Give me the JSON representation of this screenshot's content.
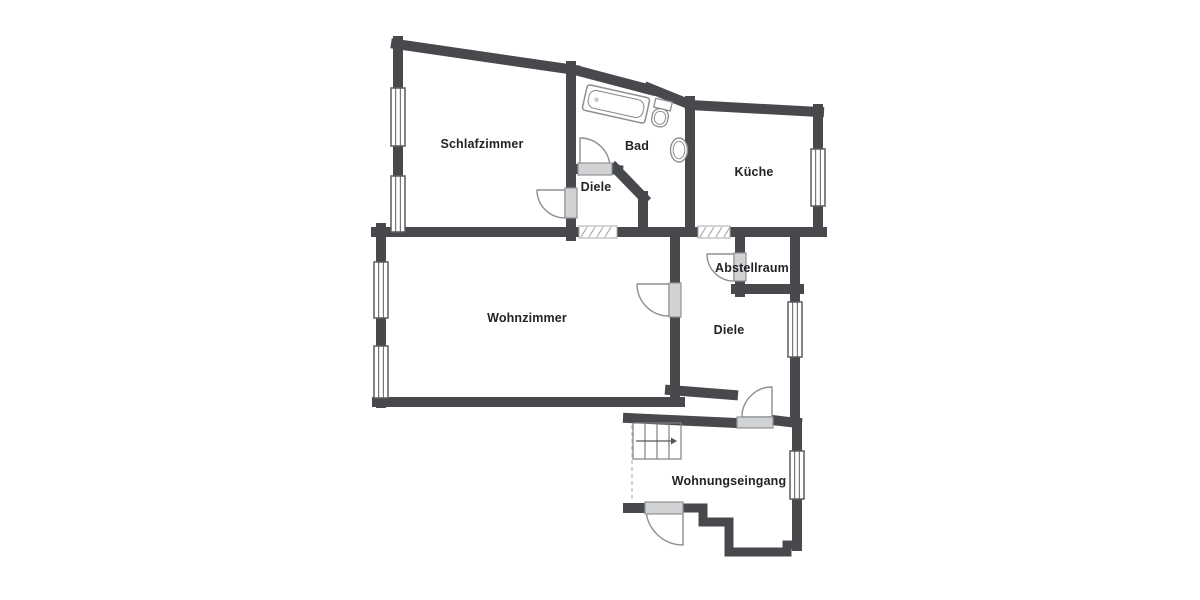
{
  "floorplan": {
    "background": "#ffffff",
    "wall_color": "#47494d",
    "line_color": "#8d8f92",
    "sill_fill": "#d0d2d4",
    "sill_border": "#909396",
    "window_border": "#5a5c60",
    "hatch_color": "#a8aaac",
    "stairs_color": "#7e8083",
    "text_color": "#222326",
    "rooms": [
      {
        "id": "schlafzimmer",
        "label": "Schlafzimmer",
        "cx": 482,
        "cy": 144
      },
      {
        "id": "bad",
        "label": "Bad",
        "cx": 637,
        "cy": 146
      },
      {
        "id": "diele-oben",
        "label": "Diele",
        "cx": 596,
        "cy": 187
      },
      {
        "id": "kueche",
        "label": "Küche",
        "cx": 754,
        "cy": 172
      },
      {
        "id": "wohnzimmer",
        "label": "Wohnzimmer",
        "cx": 527,
        "cy": 318
      },
      {
        "id": "abstellraum",
        "label": "Abstellraum",
        "cx": 752,
        "cy": 268
      },
      {
        "id": "diele-unten",
        "label": "Diele",
        "cx": 729,
        "cy": 330
      },
      {
        "id": "wohnungseingang",
        "label": "Wohnungseingang",
        "cx": 729,
        "cy": 481
      }
    ],
    "walls": [
      {
        "name": "schlafzimmer-top",
        "w": 10,
        "pts": [
          [
            396,
            44
          ],
          [
            575,
            70
          ]
        ]
      },
      {
        "name": "bad-top-a",
        "w": 10,
        "pts": [
          [
            575,
            70
          ],
          [
            651,
            90
          ]
        ]
      },
      {
        "name": "bad-top-b",
        "w": 10,
        "pts": [
          [
            649,
            88
          ],
          [
            691,
            105
          ]
        ]
      },
      {
        "name": "kueche-top",
        "w": 10,
        "pts": [
          [
            690,
            105
          ],
          [
            819,
            112
          ]
        ]
      },
      {
        "name": "kueche-right-upper",
        "w": 10,
        "pts": [
          [
            818,
            109
          ],
          [
            818,
            150
          ]
        ]
      },
      {
        "name": "kueche-right-lower",
        "w": 10,
        "pts": [
          [
            818,
            205
          ],
          [
            818,
            232
          ]
        ]
      },
      {
        "name": "schlafzimmer-left-upper",
        "w": 10,
        "pts": [
          [
            398,
            41
          ],
          [
            398,
            90
          ]
        ]
      },
      {
        "name": "schlafzimmer-left-mid",
        "w": 10,
        "pts": [
          [
            398,
            143
          ],
          [
            398,
            179
          ]
        ]
      },
      {
        "name": "schlafzimmer-right-up",
        "w": 10,
        "pts": [
          [
            571,
            66
          ],
          [
            571,
            190
          ]
        ]
      },
      {
        "name": "schlafzimmer-right-low",
        "w": 10,
        "pts": [
          [
            571,
            217
          ],
          [
            571,
            236
          ]
        ]
      },
      {
        "name": "bottom-wall-west",
        "w": 10,
        "pts": [
          [
            376,
            232
          ],
          [
            579,
            232
          ]
        ]
      },
      {
        "name": "bottom-wall-mid",
        "w": 10,
        "pts": [
          [
            615,
            232
          ],
          [
            700,
            232
          ]
        ]
      },
      {
        "name": "bottom-wall-east",
        "w": 10,
        "pts": [
          [
            728,
            232
          ],
          [
            822,
            232
          ]
        ]
      },
      {
        "name": "baddoor-stub-left",
        "w": 10,
        "pts": [
          [
            571,
            169
          ],
          [
            580,
            169
          ]
        ]
      },
      {
        "name": "baddoor-stub-right",
        "w": 10,
        "pts": [
          [
            609,
            169
          ],
          [
            618,
            170
          ]
        ]
      },
      {
        "name": "diele-bad-slant",
        "w": 10,
        "pts": [
          [
            615,
            168
          ],
          [
            644,
            198
          ]
        ]
      },
      {
        "name": "diele-bad-vertical",
        "w": 10,
        "pts": [
          [
            643,
            196
          ],
          [
            643,
            232
          ]
        ]
      },
      {
        "name": "bad-kueche-shared",
        "w": 10,
        "pts": [
          [
            690,
            101
          ],
          [
            690,
            232
          ]
        ]
      },
      {
        "name": "wohnzimmer-left-upper",
        "w": 10,
        "pts": [
          [
            381,
            228
          ],
          [
            381,
            263
          ]
        ]
      },
      {
        "name": "wohnzimmer-left-mid",
        "w": 10,
        "pts": [
          [
            381,
            317
          ],
          [
            381,
            347
          ]
        ]
      },
      {
        "name": "wohnzimmer-left-stub",
        "w": 10,
        "pts": [
          [
            381,
            397
          ],
          [
            381,
            403
          ]
        ]
      },
      {
        "name": "wohnzimmer-bottom",
        "w": 10,
        "pts": [
          [
            377,
            402
          ],
          [
            680,
            402
          ]
        ]
      },
      {
        "name": "wohnzimmer-right-upper",
        "w": 10,
        "pts": [
          [
            675,
            232
          ],
          [
            675,
            284
          ]
        ]
      },
      {
        "name": "wohnzimmer-right-lower",
        "w": 10,
        "pts": [
          [
            675,
            316
          ],
          [
            675,
            401
          ]
        ]
      },
      {
        "name": "diele-bottom-slant",
        "w": 10,
        "pts": [
          [
            670,
            390
          ],
          [
            733,
            395
          ]
        ]
      },
      {
        "name": "eingang-top",
        "w": 10,
        "pts": [
          [
            628,
            418
          ],
          [
            737,
            423
          ]
        ]
      },
      {
        "name": "eingang-door-stub",
        "w": 10,
        "pts": [
          [
            772,
            420
          ],
          [
            797,
            423
          ]
        ]
      },
      {
        "name": "east-wall-upper",
        "w": 10,
        "pts": [
          [
            795,
            232
          ],
          [
            795,
            303
          ]
        ]
      },
      {
        "name": "east-wall-mid",
        "w": 10,
        "pts": [
          [
            795,
            357
          ],
          [
            795,
            421
          ]
        ]
      },
      {
        "name": "abstellraum-left-upper",
        "w": 10,
        "pts": [
          [
            740,
            237
          ],
          [
            740,
            254
          ]
        ]
      },
      {
        "name": "abstellraum-left-lower",
        "w": 10,
        "pts": [
          [
            740,
            280
          ],
          [
            740,
            292
          ]
        ]
      },
      {
        "name": "abstellraum-bottom",
        "w": 10,
        "pts": [
          [
            736,
            289
          ],
          [
            799,
            289
          ]
        ]
      },
      {
        "name": "eingang-right-upper",
        "w": 10,
        "pts": [
          [
            797,
            423
          ],
          [
            797,
            453
          ]
        ]
      },
      {
        "name": "eingang-right-lower",
        "w": 10,
        "pts": [
          [
            797,
            498
          ],
          [
            797,
            546
          ]
        ]
      },
      {
        "name": "eingang-bottom-zigzag",
        "w": 9,
        "pts": [
          [
            797,
            545
          ],
          [
            787,
            545
          ],
          [
            787,
            552
          ],
          [
            729,
            552
          ],
          [
            729,
            522
          ],
          [
            703,
            522
          ],
          [
            703,
            508
          ],
          [
            684,
            508
          ]
        ]
      },
      {
        "name": "eingang-bottom-left",
        "w": 10,
        "pts": [
          [
            646,
            508
          ],
          [
            628,
            508
          ]
        ]
      }
    ],
    "windows": [
      {
        "name": "window-schlafzimmer-1",
        "x": 391,
        "y": 88,
        "w": 14,
        "h": 58
      },
      {
        "name": "window-schlafzimmer-2",
        "x": 391,
        "y": 176,
        "w": 14,
        "h": 56
      },
      {
        "name": "window-wohnzimmer-1",
        "x": 374,
        "y": 262,
        "w": 14,
        "h": 56
      },
      {
        "name": "window-wohnzimmer-2",
        "x": 374,
        "y": 346,
        "w": 14,
        "h": 52
      },
      {
        "name": "window-kueche",
        "x": 811,
        "y": 149,
        "w": 14,
        "h": 57
      },
      {
        "name": "window-diele",
        "x": 788,
        "y": 302,
        "w": 14,
        "h": 55
      },
      {
        "name": "window-eingang",
        "x": 790,
        "y": 451,
        "w": 14,
        "h": 48
      }
    ],
    "door_sills": [
      {
        "name": "sill-schlafzimmer",
        "x": 565,
        "y": 188,
        "w": 12,
        "h": 30
      },
      {
        "name": "sill-bad",
        "x": 578,
        "y": 163,
        "w": 34,
        "h": 12
      },
      {
        "name": "sill-wohnzimmer",
        "x": 669,
        "y": 283,
        "w": 12,
        "h": 34
      },
      {
        "name": "sill-abstellraum",
        "x": 734,
        "y": 253,
        "w": 12,
        "h": 28
      },
      {
        "name": "sill-diele-eingang",
        "x": 737,
        "y": 417,
        "w": 36,
        "h": 11
      },
      {
        "name": "sill-haustuer",
        "x": 645,
        "y": 502,
        "w": 38,
        "h": 12
      }
    ],
    "door_arcs": [
      {
        "name": "door-schlafzimmer",
        "hx": 565,
        "hy": 190,
        "lx": 537,
        "ly": 190,
        "ex": 565,
        "ey": 218,
        "r": 28,
        "sweep": 0
      },
      {
        "name": "door-bad",
        "hx": 580,
        "hy": 168,
        "lx": 580,
        "ly": 138,
        "ex": 610,
        "ey": 168,
        "r": 30,
        "sweep": 1
      },
      {
        "name": "door-wohnzimmer",
        "hx": 669,
        "hy": 284,
        "lx": 637,
        "ly": 284,
        "ex": 669,
        "ey": 316,
        "r": 32,
        "sweep": 0
      },
      {
        "name": "door-abstellraum",
        "hx": 734,
        "hy": 254,
        "lx": 707,
        "ly": 254,
        "ex": 734,
        "ey": 281,
        "r": 27,
        "sweep": 0
      },
      {
        "name": "door-diele-eingang",
        "hx": 772,
        "hy": 417,
        "lx": 772,
        "ly": 387,
        "ex": 742,
        "ey": 417,
        "r": 30,
        "sweep": 0
      },
      {
        "name": "door-haustuer",
        "hx": 683,
        "hy": 508,
        "lx": 683,
        "ly": 545,
        "ex": 646,
        "ey": 508,
        "r": 37,
        "sweep": 1
      }
    ],
    "openings": [
      {
        "name": "opening-wohnzimmer-diele",
        "x": 579,
        "y": 226,
        "w": 38,
        "h": 12
      },
      {
        "name": "opening-kueche-diele",
        "x": 698,
        "y": 226,
        "w": 32,
        "h": 12
      }
    ],
    "dashed_lines": [
      {
        "name": "open-boundary-eingang",
        "x1": 632,
        "y1": 425,
        "x2": 632,
        "y2": 502
      }
    ],
    "stairs": {
      "x": 633,
      "y": 423,
      "w": 48,
      "h": 36,
      "treads": [
        645,
        657,
        669
      ],
      "arrow_y": 441,
      "arrow_x1": 636,
      "arrow_x2": 677
    },
    "fixtures": {
      "bathtub": {
        "cx": 616,
        "cy": 104,
        "w": 64,
        "h": 26,
        "rot": 12.5
      },
      "toilet": {
        "cx": 662,
        "cy": 109,
        "rot": 13
      },
      "sink": {
        "cx": 679,
        "cy": 150,
        "rx": 8.5,
        "ry": 12
      }
    }
  }
}
